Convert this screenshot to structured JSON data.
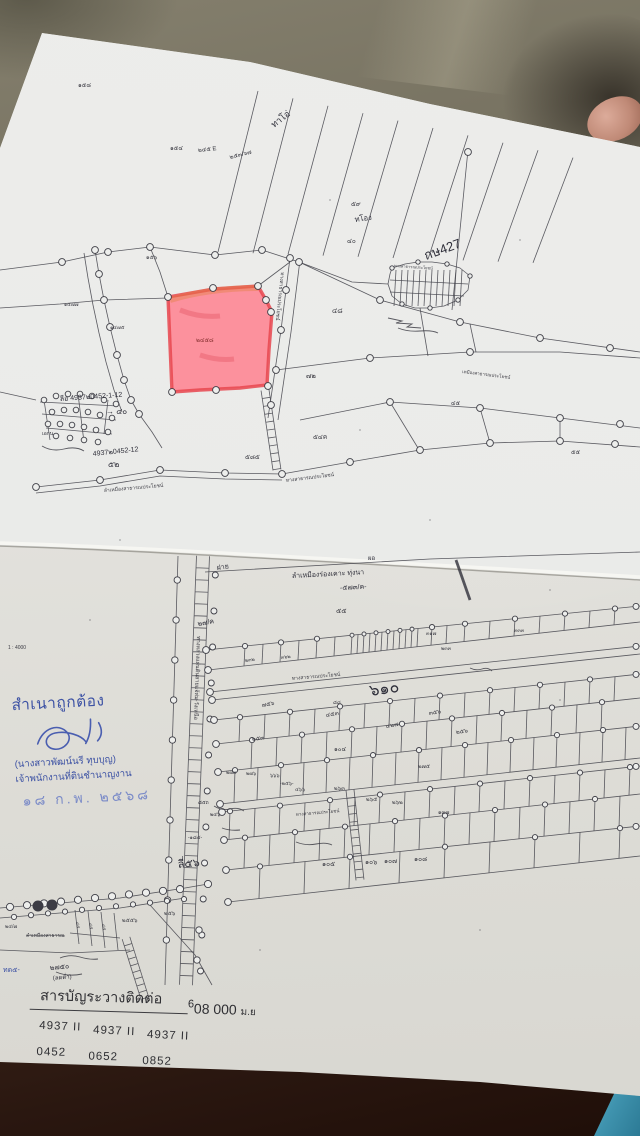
{
  "colors": {
    "ink": "#3c3c44",
    "pen": "#2f2f3a",
    "stamp_blue": "#3d52a4",
    "stamp_blue_light": "#7c8cc8",
    "highlight_pink": "#ff7d8c",
    "highlight_border": "#e8474f",
    "red_label": "#8a3434"
  },
  "stamp": {
    "line1": "สำเนาถูกต้อง",
    "name": "(นางสาวพัฒน์นรี ทุบบุญ)",
    "title": "เจ้าพนักงานที่ดินชำนาญงาน",
    "date": "๑๘ ก.พ. ๒๕๖๘"
  },
  "footer": {
    "title": "สารบัญระวางติดต่อ",
    "coordinate_sup": "6",
    "coordinate": "08 000",
    "coordinate_unit": "ม.ย",
    "sheet_numbers": [
      "4937 II",
      "4937 II",
      "4937 II"
    ],
    "sheet_pages": [
      "0452",
      "0652",
      "0852"
    ]
  },
  "map_labels": [
    {
      "t": "๑๕๘",
      "x": 78,
      "y": 87,
      "s": 6
    },
    {
      "t": "๑๕๔",
      "x": 170,
      "y": 150,
      "s": 6
    },
    {
      "t": "๒๔๕ E",
      "x": 198,
      "y": 152,
      "s": 6,
      "r": -6
    },
    {
      "t": "๒๕๓/๖๗",
      "x": 230,
      "y": 159,
      "s": 6,
      "r": -14
    },
    {
      "t": "ทาโอ่",
      "x": 274,
      "y": 128,
      "s": 9,
      "r": -38,
      "c": "pen"
    },
    {
      "t": "๕๙",
      "x": 351,
      "y": 206,
      "s": 6.5
    },
    {
      "t": "ทโอง",
      "x": 355,
      "y": 222,
      "s": 7.5,
      "r": -8,
      "c": "pen"
    },
    {
      "t": "๔๐",
      "x": 347,
      "y": 243,
      "s": 6.5
    },
    {
      "t": "กษ427",
      "x": 426,
      "y": 260,
      "s": 13,
      "r": -20,
      "c": "pen"
    },
    {
      "t": "ทางสาธารณประโยชน์",
      "x": 394,
      "y": 267,
      "s": 4,
      "r": 4
    },
    {
      "t": "๑๕๖",
      "x": 146,
      "y": 259,
      "s": 5.5
    },
    {
      "t": "๑๔๗๗",
      "x": 64,
      "y": 306,
      "s": 5
    },
    {
      "t": "๑๔๗๕",
      "x": 110,
      "y": 329,
      "s": 5
    },
    {
      "t": "๔๘",
      "x": 332,
      "y": 313,
      "s": 7
    },
    {
      "t": "๗๒",
      "x": 306,
      "y": 378,
      "s": 7
    },
    {
      "t": "๔๕",
      "x": 451,
      "y": 405,
      "s": 6
    },
    {
      "t": "๕๕",
      "x": 571,
      "y": 454,
      "s": 6
    },
    {
      "t": "ทางสาธารณประโยชน์",
      "x": 281,
      "y": 272,
      "s": 5,
      "r": 96
    },
    {
      "t": "๒๔๕๘",
      "x": 196,
      "y": 342,
      "s": 6,
      "c": "red_label"
    },
    {
      "t": "ลีอ 4937๒0452-1-12",
      "x": 60,
      "y": 401,
      "s": 7,
      "r": -4,
      "c": "pen"
    },
    {
      "t": "→ ๔๐",
      "x": 106,
      "y": 414,
      "s": 8,
      "c": "pen"
    },
    {
      "t": "4937๒0452-12",
      "x": 93,
      "y": 456,
      "s": 7,
      "r": -6,
      "c": "pen"
    },
    {
      "t": "๕๒",
      "x": 108,
      "y": 467,
      "s": 8,
      "c": "pen"
    },
    {
      "t": "เอกน",
      "x": 42,
      "y": 435,
      "s": 5,
      "c": "pen"
    },
    {
      "t": "ลำเหมืองสาธารณประโยชน์",
      "x": 104,
      "y": 492,
      "s": 5,
      "r": -5
    },
    {
      "t": "ทางสาธารณประโยชน์",
      "x": 286,
      "y": 482,
      "s": 5,
      "r": -7
    },
    {
      "t": "๕๘๕",
      "x": 245,
      "y": 459,
      "s": 6.5
    },
    {
      "t": "๕๔ค",
      "x": 313,
      "y": 439,
      "s": 6.5
    },
    {
      "t": "เหมืองสาธารณประโยชน์",
      "x": 462,
      "y": 373,
      "s": 4.5,
      "r": 7
    },
    {
      "t": "1 : 4000",
      "x": 8,
      "y": 649,
      "s": 5,
      "n": "scale-note"
    },
    {
      "t": "ฝาย",
      "x": 217,
      "y": 570,
      "s": 7,
      "r": -8,
      "c": "pen"
    },
    {
      "t": "ลำเหมืองร่องเคาะ ทุ่งนา",
      "x": 292,
      "y": 578,
      "s": 7,
      "r": -3,
      "c": "pen"
    },
    {
      "t": "-๕๗๓/ค-",
      "x": 340,
      "y": 590,
      "s": 7,
      "r": -3,
      "c": "pen"
    },
    {
      "t": "ผอ",
      "x": 368,
      "y": 560,
      "s": 6,
      "c": "pen"
    },
    {
      "t": "๒๗/ค",
      "x": 198,
      "y": 626,
      "s": 7,
      "r": -10,
      "c": "pen"
    },
    {
      "t": "๕๕",
      "x": 336,
      "y": 613,
      "s": 7
    },
    {
      "t": "๒๓๒",
      "x": 245,
      "y": 662,
      "s": 5,
      "r": -7
    },
    {
      "t": "๓๖๒",
      "x": 281,
      "y": 659,
      "s": 5,
      "r": -7
    },
    {
      "t": "๓๑๗",
      "x": 426,
      "y": 635,
      "s": 5
    },
    {
      "t": "๒๓๓",
      "x": 441,
      "y": 650,
      "s": 5
    },
    {
      "t": "๓๓๓",
      "x": 514,
      "y": 632,
      "s": 5
    },
    {
      "t": "ทางสาธารณประโยชน์",
      "x": 292,
      "y": 680,
      "s": 5,
      "r": -5
    },
    {
      "t": "๖๑๐",
      "x": 370,
      "y": 696,
      "s": 16,
      "r": -8,
      "c": "pen"
    },
    {
      "t": "๘๘",
      "x": 333,
      "y": 704,
      "s": 5
    },
    {
      "t": "๗๕๖",
      "x": 262,
      "y": 707,
      "s": 6,
      "r": -10
    },
    {
      "t": "๔๕๓",
      "x": 326,
      "y": 717,
      "s": 6,
      "r": -10
    },
    {
      "t": "๔๒๗",
      "x": 386,
      "y": 728,
      "s": 6,
      "r": -10
    },
    {
      "t": "๓๕๖",
      "x": 429,
      "y": 715,
      "s": 6,
      "r": -8
    },
    {
      "t": "๒๕๖",
      "x": 456,
      "y": 734,
      "s": 6,
      "r": -8
    },
    {
      "t": "๒๕๓",
      "x": 252,
      "y": 741,
      "s": 6,
      "r": -8
    },
    {
      "t": "๑๐๔",
      "x": 334,
      "y": 751,
      "s": 6
    },
    {
      "t": "๒๗๓",
      "x": 226,
      "y": 774,
      "s": 5
    },
    {
      "t": "๒๗๖",
      "x": 246,
      "y": 775,
      "s": 5
    },
    {
      "t": "๖๖๖",
      "x": 270,
      "y": 777,
      "s": 5
    },
    {
      "t": "๒๗๕",
      "x": 418,
      "y": 768,
      "s": 5.5
    },
    {
      "t": "-๒๕๖-",
      "x": 280,
      "y": 785,
      "s": 5
    },
    {
      "t": "๔๖๖",
      "x": 295,
      "y": 791,
      "s": 5
    },
    {
      "t": "๒๖๓",
      "x": 334,
      "y": 790,
      "s": 5.5
    },
    {
      "t": "๒๖๕",
      "x": 366,
      "y": 801,
      "s": 5.5
    },
    {
      "t": "๒๖๒",
      "x": 392,
      "y": 804,
      "s": 5.5
    },
    {
      "t": "๑๓๗",
      "x": 438,
      "y": 814,
      "s": 5.5
    },
    {
      "t": "ทางสาธารณประโยชน์",
      "x": 296,
      "y": 816,
      "s": 4.5,
      "r": -5
    },
    {
      "t": "ลี่๕๖",
      "x": 178,
      "y": 868,
      "s": 11,
      "r": -5,
      "c": "pen"
    },
    {
      "t": "๑๐๕",
      "x": 322,
      "y": 866,
      "s": 6.5
    },
    {
      "t": "๑๐๖",
      "x": 365,
      "y": 864,
      "s": 6.5
    },
    {
      "t": "๑๐๗",
      "x": 384,
      "y": 863,
      "s": 6.5
    },
    {
      "t": "๑๐๘",
      "x": 414,
      "y": 861,
      "s": 6.5
    },
    {
      "t": "ทางหลวงแผ่นดินสายแจ้ห่ม-วังเหนือ",
      "x": 197,
      "y": 636,
      "s": 5.5,
      "r": 92
    },
    {
      "t": "๘๕ถ",
      "x": 198,
      "y": 804,
      "s": 5,
      "c": "pen"
    },
    {
      "t": "๒๔๖",
      "x": 210,
      "y": 816,
      "s": 5,
      "c": "pen"
    },
    {
      "t": "-๑๘๔-",
      "x": 188,
      "y": 839,
      "s": 5,
      "c": "pen"
    },
    {
      "t": "๒๗๕๐",
      "x": 50,
      "y": 970,
      "s": 7,
      "r": -5,
      "c": "pen"
    },
    {
      "t": "(ลดต่ำ)",
      "x": 53,
      "y": 980,
      "s": 6,
      "r": -5,
      "c": "pen"
    },
    {
      "t": "ทด๕-",
      "x": 3,
      "y": 972,
      "s": 7,
      "c": "stamp_blue"
    },
    {
      "t": "๒๕๕๖",
      "x": 122,
      "y": 922,
      "s": 5.5
    },
    {
      "t": "๒๕๖",
      "x": 164,
      "y": 915,
      "s": 5.5
    },
    {
      "t": "ลำเหมืองสาธารณ",
      "x": 26,
      "y": 937,
      "s": 5,
      "td": 1
    },
    {
      "t": "๒๔/๗",
      "x": 5,
      "y": 928,
      "s": 5
    },
    {
      "t": "๔๕",
      "x": 76,
      "y": 922,
      "s": 4.5,
      "r": 80
    },
    {
      "t": "๔๕",
      "x": 89,
      "y": 923,
      "s": 4.5,
      "r": 80
    },
    {
      "t": "๔๕",
      "x": 102,
      "y": 924,
      "s": 4.5,
      "r": 80
    }
  ]
}
